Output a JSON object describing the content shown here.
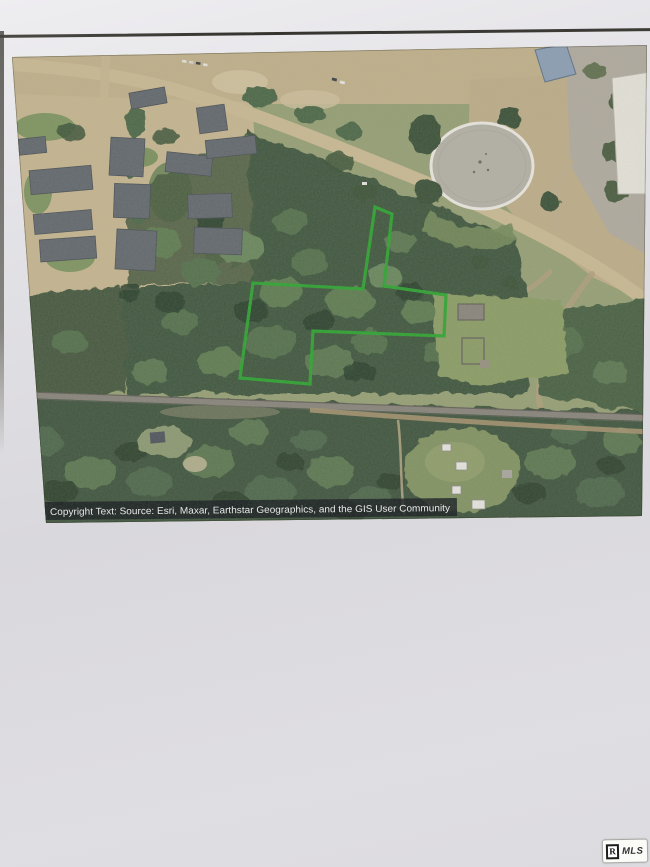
{
  "map": {
    "copyright": "Copyright Text: Source: Esri, Maxar, Earthstar Geographics, and the GIS User Community",
    "boundary_points": "365,165 382,172 374,244 436,253 434,294 303,289 300,342 230,336 243,241 353,247",
    "boundary_color": "#2ca62c"
  },
  "watermark": {
    "realtor_letter": "R",
    "mls_label": "MLS"
  },
  "colors": {
    "paper": "#dcdbdf",
    "grass": "#97a172",
    "forest": "#42573b",
    "forest_dark": "#3a4f35",
    "dirt_road": "#cdbb92",
    "tan_ground": "#c7b58c",
    "plaza_gray": "#b3ab9d",
    "tank_pad": "#b6b2a5",
    "tank_ring": "#ece9df",
    "roof_gray": "#62686b",
    "roof_blue": "#8ea0b4",
    "railroad": "#8a847a",
    "copyright_bar": "#14171a"
  }
}
